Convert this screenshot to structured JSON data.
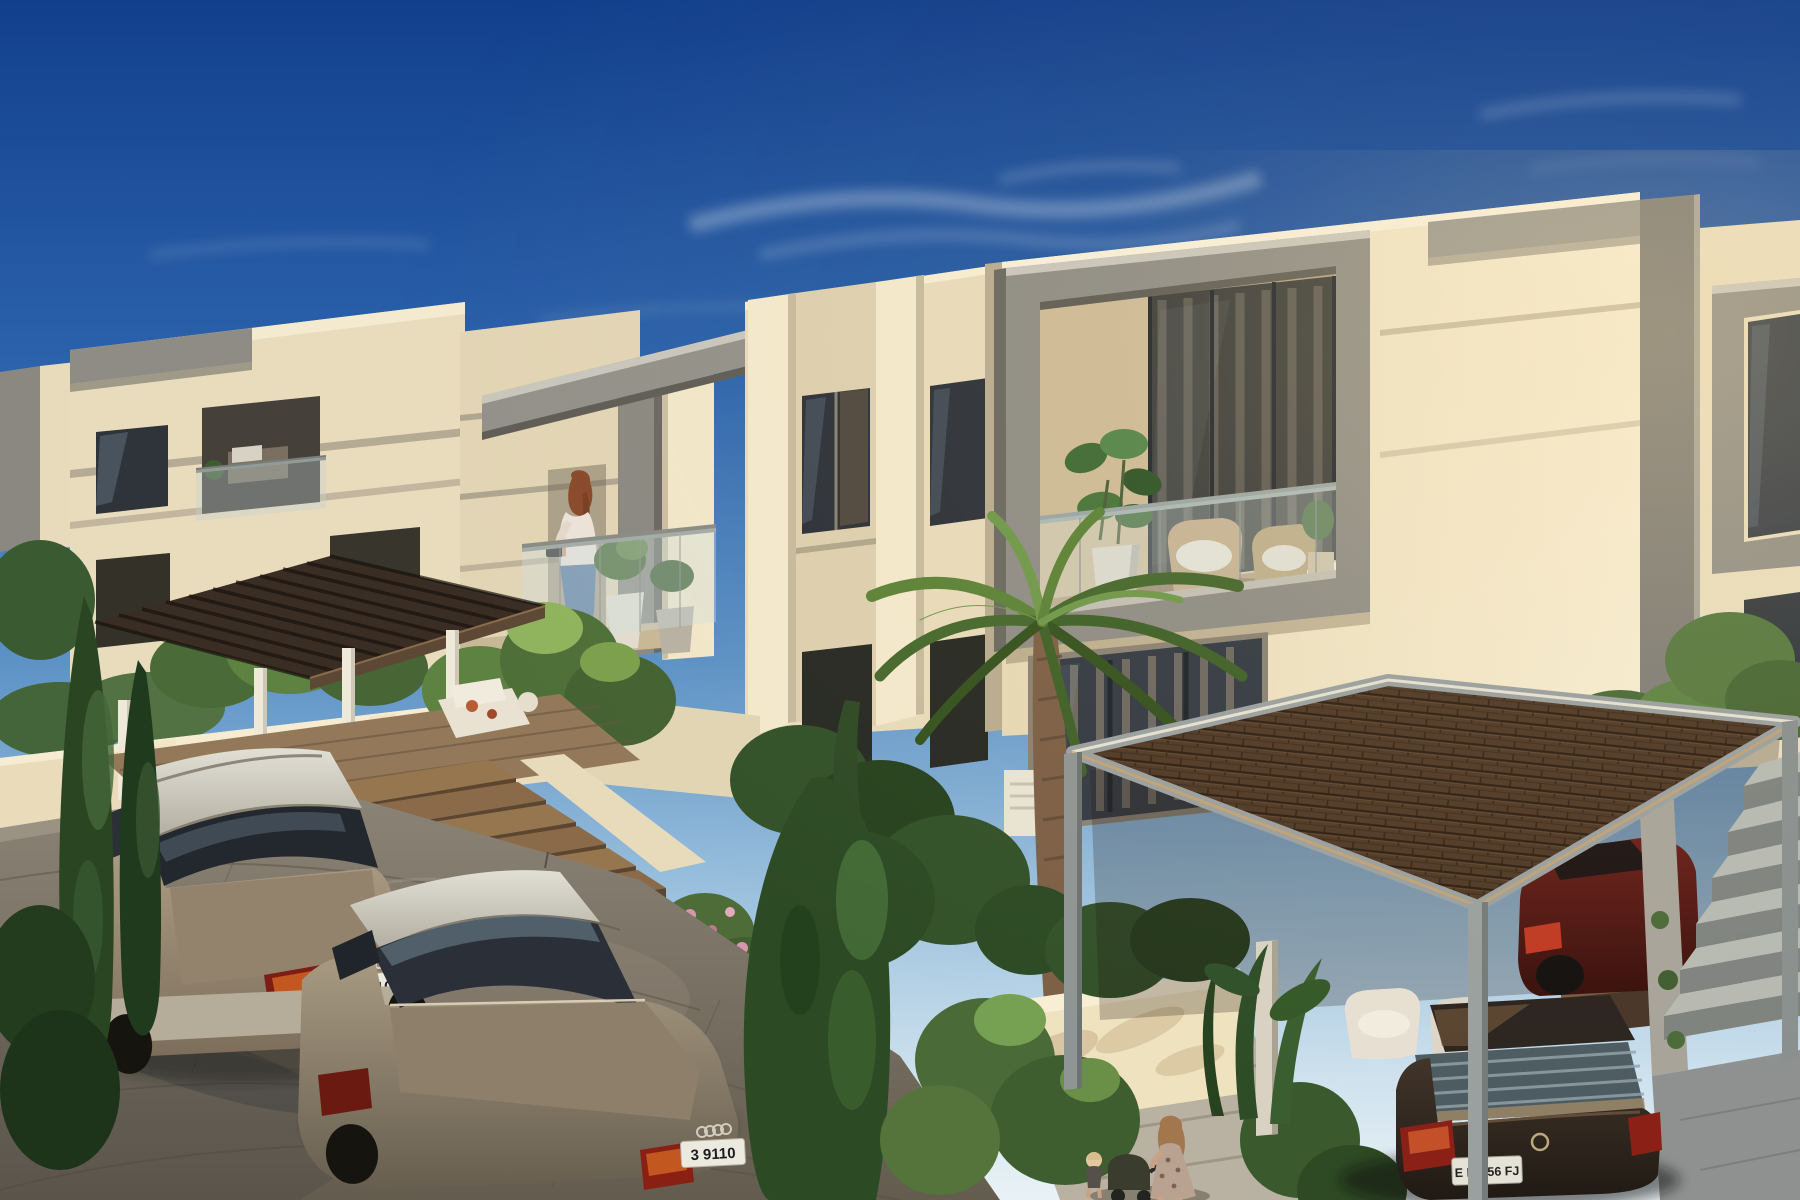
{
  "meta": {
    "scene_type": "3d-architectural-rendering",
    "title": "Modern townhouse community at golden hour",
    "view": "elevated street-corner view with landscaped gardens and parked cars"
  },
  "palette": {
    "sky_top": "#123f8c",
    "sky_mid": "#5d92c6",
    "sky_horizon": "#e9f2f6",
    "wall_sunlit": "#f2e7cb",
    "wall_mid": "#e4d7b6",
    "wall_shaded": "#cfc2a6",
    "accent_grey": "#8f8d86",
    "glass_dark": "#2e343c",
    "roof_tile": "#4e3926",
    "pergola_wood": "#3a2d23",
    "foliage_dark": "#2e4a26",
    "foliage_light": "#6f9446",
    "street": "#8c8476",
    "plate_bg": "#eceadf"
  },
  "vehicles": {
    "wagon": {
      "type": "estate-wagon",
      "color_name": "champagne silver",
      "plate": "3 9110"
    },
    "coupe": {
      "type": "coupe",
      "color_name": "bronze grey",
      "plate": "3 9110"
    },
    "sedan": {
      "type": "sedan",
      "color_name": "dark brown",
      "plate": "E BS 56 FJ"
    },
    "compact": {
      "type": "parked-car",
      "color_name": "dark red"
    }
  },
  "people": {
    "balcony_resident": "woman at balcony railing",
    "walking_mother": "woman with stroller",
    "toddler": "small child"
  }
}
